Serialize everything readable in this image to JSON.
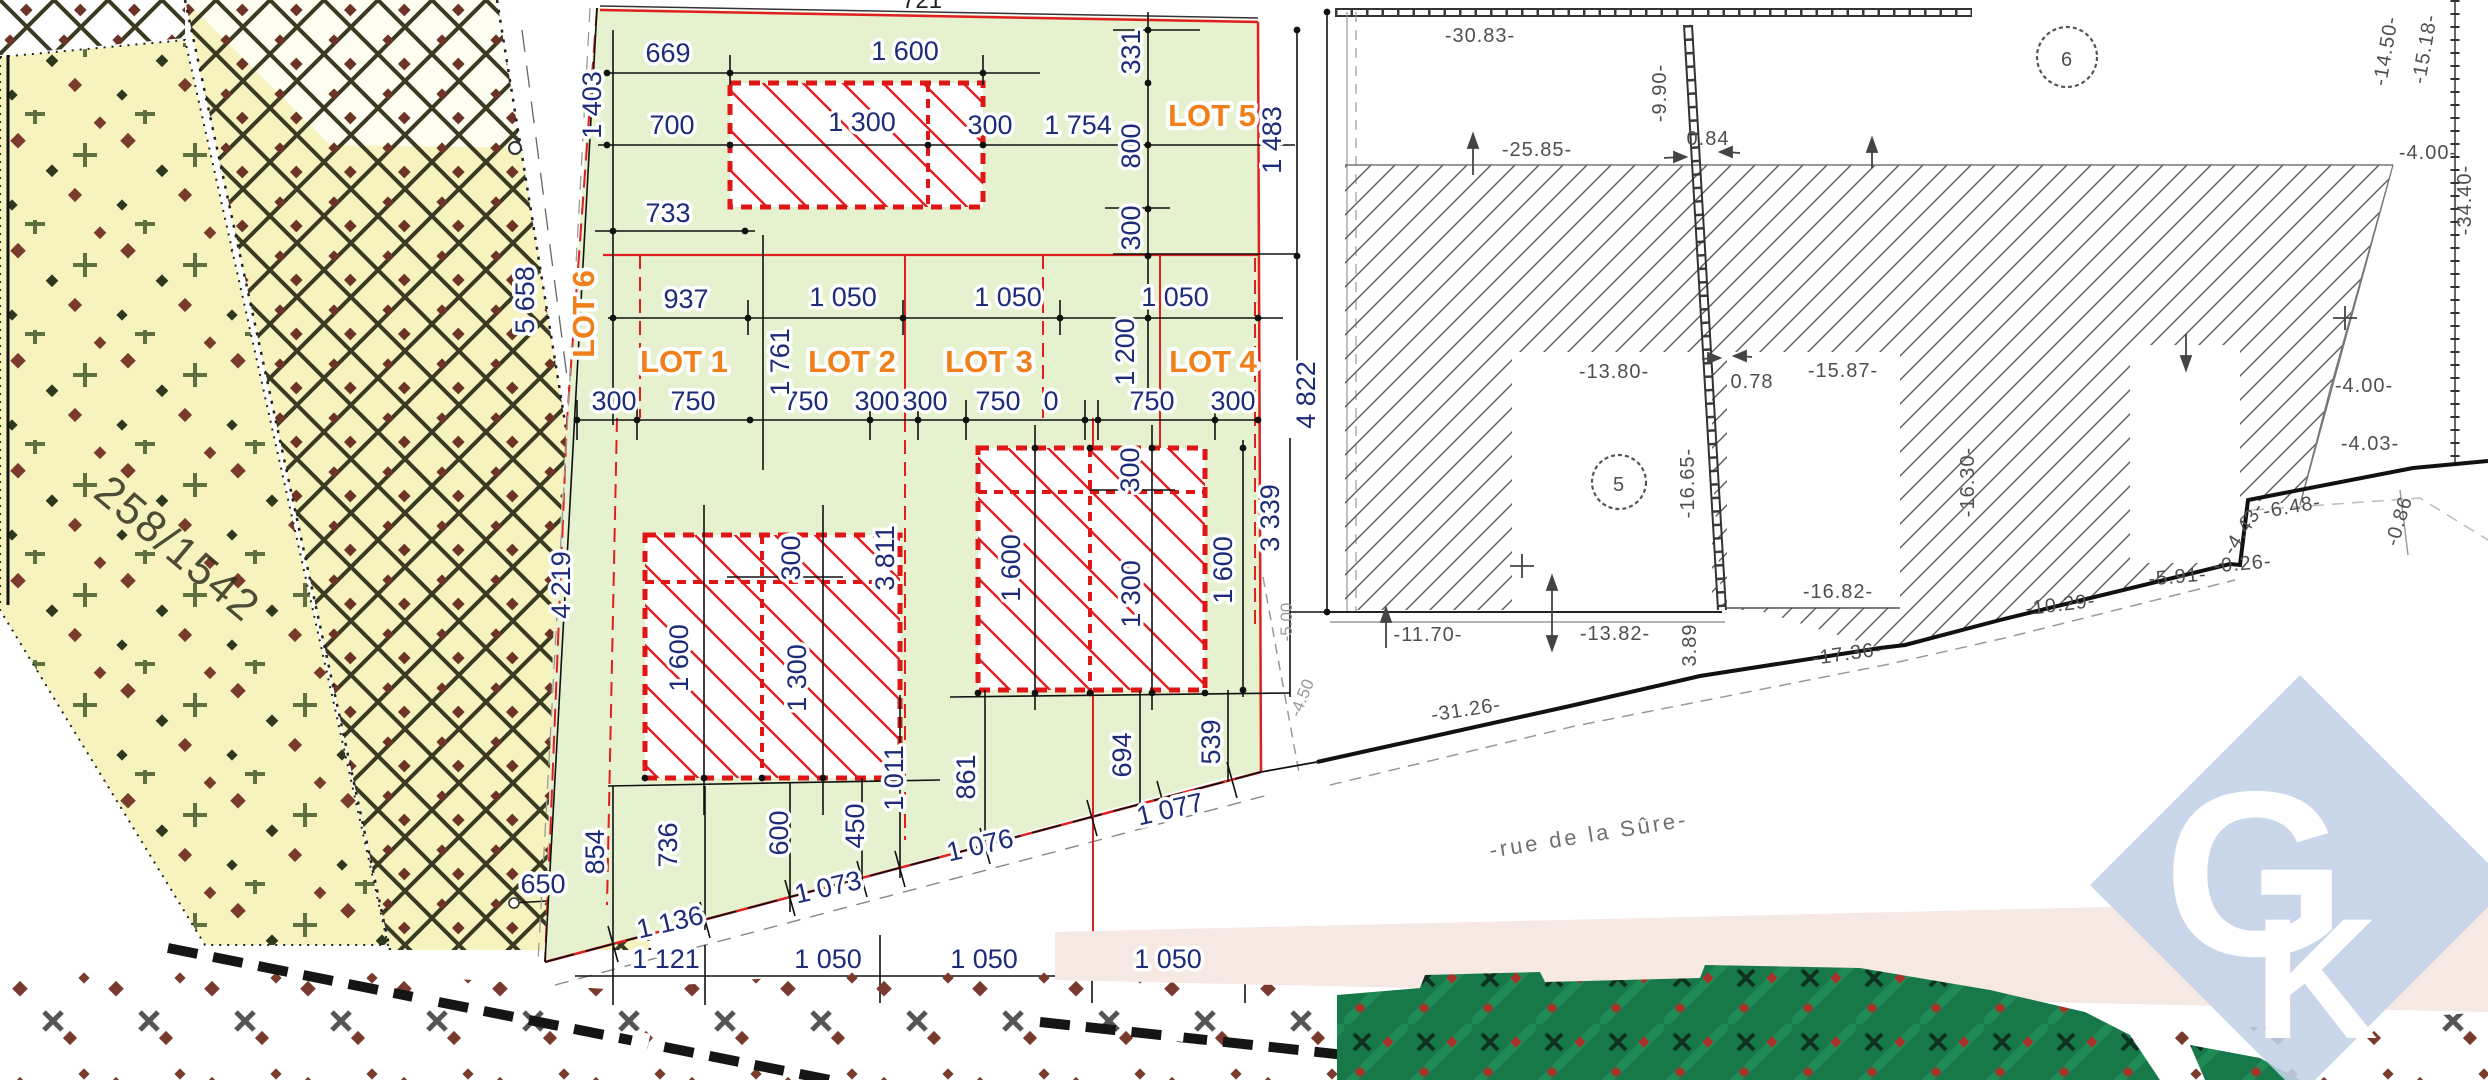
{
  "plan": {
    "street_name": "-rue de la Sûre-",
    "parcel_number": "258/1542",
    "lot_names": [
      "LOT 1",
      "LOT 2",
      "LOT 3",
      "LOT 4",
      "LOT 5",
      "LOT 6"
    ],
    "circled_parcels": [
      "5",
      "6"
    ]
  },
  "logo": {
    "g": "G",
    "k": "K"
  },
  "colors": {
    "green_area": "#e5f1cf",
    "lot_label_orange": "#f07f1a",
    "dimension_navy": "#1c2c78",
    "building_red": "#e01515",
    "parcel_yellow": "#f6f3bf",
    "pink_band": "#f6e8e3",
    "dark_green": "#17794a",
    "logo_blue": "#c3d2e8",
    "survey_grey": "#4f4f4f"
  },
  "labels": [
    {
      "t": "669",
      "x": 668,
      "y": 62,
      "r": 0,
      "c": "dim"
    },
    {
      "t": "1 600",
      "x": 905,
      "y": 60,
      "r": 0,
      "c": "dim"
    },
    {
      "t": "700",
      "x": 672,
      "y": 134,
      "r": 0,
      "c": "dim"
    },
    {
      "t": "1 300",
      "x": 862,
      "y": 131,
      "r": 0,
      "c": "dim"
    },
    {
      "t": "300",
      "x": 990,
      "y": 134,
      "r": 0,
      "c": "dim"
    },
    {
      "t": "733",
      "x": 668,
      "y": 222,
      "r": 0,
      "c": "dim"
    },
    {
      "t": "1 754",
      "x": 1078,
      "y": 134,
      "r": 0,
      "c": "dim"
    },
    {
      "t": "937",
      "x": 686,
      "y": 308,
      "r": 0,
      "c": "dim"
    },
    {
      "t": "1 050",
      "x": 843,
      "y": 306,
      "r": 0,
      "c": "dim"
    },
    {
      "t": "1 050",
      "x": 1008,
      "y": 306,
      "r": 0,
      "c": "dim"
    },
    {
      "t": "1 050",
      "x": 1175,
      "y": 306,
      "r": 0,
      "c": "dim"
    },
    {
      "t": "300",
      "x": 614,
      "y": 410,
      "r": 0,
      "c": "dim"
    },
    {
      "t": "750",
      "x": 693,
      "y": 410,
      "r": 0,
      "c": "dim"
    },
    {
      "t": "750",
      "x": 806,
      "y": 410,
      "r": 0,
      "c": "dim"
    },
    {
      "t": "300",
      "x": 877,
      "y": 410,
      "r": 0,
      "c": "dim"
    },
    {
      "t": "300",
      "x": 925,
      "y": 410,
      "r": 0,
      "c": "dim"
    },
    {
      "t": "750",
      "x": 998,
      "y": 410,
      "r": 0,
      "c": "dim"
    },
    {
      "t": "0",
      "x": 1051,
      "y": 410,
      "r": 0,
      "c": "dim"
    },
    {
      "t": "750",
      "x": 1152,
      "y": 410,
      "r": 0,
      "c": "dim"
    },
    {
      "t": "300",
      "x": 1233,
      "y": 410,
      "r": 0,
      "c": "dim"
    },
    {
      "t": "650",
      "x": 543,
      "y": 893,
      "r": 0,
      "c": "dim"
    },
    {
      "t": "1 121",
      "x": 666,
      "y": 968,
      "r": 0,
      "c": "dim"
    },
    {
      "t": "1 050",
      "x": 828,
      "y": 968,
      "r": 0,
      "c": "dim"
    },
    {
      "t": "1 050",
      "x": 984,
      "y": 968,
      "r": 0,
      "c": "dim"
    },
    {
      "t": "1 050",
      "x": 1168,
      "y": 968,
      "r": 0,
      "c": "dim"
    },
    {
      "t": "1 403",
      "x": 601,
      "y": 105,
      "r": -90,
      "c": "dim"
    },
    {
      "t": "331",
      "x": 1140,
      "y": 52,
      "r": -90,
      "c": "dim"
    },
    {
      "t": "800",
      "x": 1140,
      "y": 146,
      "r": -90,
      "c": "dim"
    },
    {
      "t": "300",
      "x": 1140,
      "y": 228,
      "r": -90,
      "c": "dim"
    },
    {
      "t": "1 483",
      "x": 1281,
      "y": 140,
      "r": -90,
      "c": "dim"
    },
    {
      "t": "4 822",
      "x": 1315,
      "y": 395,
      "r": -90,
      "c": "dim"
    },
    {
      "t": "1 761",
      "x": 789,
      "y": 362,
      "r": -90,
      "c": "dim"
    },
    {
      "t": "1 200",
      "x": 1134,
      "y": 352,
      "r": -90,
      "c": "dim"
    },
    {
      "t": "5 658",
      "x": 534,
      "y": 300,
      "r": -90,
      "c": "dim"
    },
    {
      "t": "4 219",
      "x": 570,
      "y": 585,
      "r": -90,
      "c": "dim"
    },
    {
      "t": "300",
      "x": 800,
      "y": 558,
      "r": -90,
      "c": "dim"
    },
    {
      "t": "1 600",
      "x": 688,
      "y": 658,
      "r": -90,
      "c": "dim"
    },
    {
      "t": "1 300",
      "x": 806,
      "y": 678,
      "r": -90,
      "c": "dim"
    },
    {
      "t": "3 811",
      "x": 894,
      "y": 558,
      "r": -90,
      "c": "dim"
    },
    {
      "t": "450",
      "x": 864,
      "y": 826,
      "r": -90,
      "c": "dim"
    },
    {
      "t": "1 011",
      "x": 903,
      "y": 778,
      "r": -90,
      "c": "dim"
    },
    {
      "t": "854",
      "x": 604,
      "y": 852,
      "r": -90,
      "c": "dim"
    },
    {
      "t": "736",
      "x": 677,
      "y": 845,
      "r": -90,
      "c": "dim"
    },
    {
      "t": "600",
      "x": 788,
      "y": 833,
      "r": -90,
      "c": "dim"
    },
    {
      "t": "861",
      "x": 975,
      "y": 777,
      "r": -90,
      "c": "dim"
    },
    {
      "t": "694",
      "x": 1131,
      "y": 755,
      "r": -90,
      "c": "dim"
    },
    {
      "t": "539",
      "x": 1220,
      "y": 742,
      "r": -90,
      "c": "dim"
    },
    {
      "t": "300",
      "x": 1139,
      "y": 470,
      "r": -90,
      "c": "dim"
    },
    {
      "t": "1 600",
      "x": 1020,
      "y": 568,
      "r": -90,
      "c": "dim"
    },
    {
      "t": "1 300",
      "x": 1140,
      "y": 594,
      "r": -90,
      "c": "dim"
    },
    {
      "t": "1 600",
      "x": 1232,
      "y": 570,
      "r": -90,
      "c": "dim"
    },
    {
      "t": "3 339",
      "x": 1279,
      "y": 518,
      "r": -90,
      "c": "dim"
    },
    {
      "t": "1 136",
      "x": 672,
      "y": 931,
      "r": -13,
      "c": "dim"
    },
    {
      "t": "1 073",
      "x": 830,
      "y": 896,
      "r": -13,
      "c": "dim"
    },
    {
      "t": "1 076",
      "x": 982,
      "y": 854,
      "r": -13,
      "c": "dim"
    },
    {
      "t": "1 077",
      "x": 1172,
      "y": 818,
      "r": -13,
      "c": "dim"
    },
    {
      "t": "LOT 1",
      "x": 684,
      "y": 372,
      "r": 0,
      "c": "lot"
    },
    {
      "t": "LOT 2",
      "x": 852,
      "y": 372,
      "r": 0,
      "c": "lot"
    },
    {
      "t": "LOT 3",
      "x": 989,
      "y": 372,
      "r": 0,
      "c": "lot"
    },
    {
      "t": "LOT 4",
      "x": 1213,
      "y": 372,
      "r": 0,
      "c": "lot"
    },
    {
      "t": "LOT 5",
      "x": 1212,
      "y": 126,
      "r": 0,
      "c": "lot"
    },
    {
      "t": "LOT 6",
      "x": 594,
      "y": 314,
      "r": -90,
      "c": "lot"
    },
    {
      "t": "-5.00",
      "x": 1292,
      "y": 622,
      "r": -90,
      "c": "grey"
    },
    {
      "t": "-4.50",
      "x": 1307,
      "y": 700,
      "r": -68,
      "c": "grey"
    },
    {
      "t": "-30.83-",
      "x": 1480,
      "y": 42,
      "r": 0,
      "c": "surv"
    },
    {
      "t": "-25.85-",
      "x": 1537,
      "y": 156,
      "r": 0,
      "c": "surv"
    },
    {
      "t": "0.84",
      "x": 1708,
      "y": 145,
      "r": 0,
      "c": "surv"
    },
    {
      "t": "-9.90-",
      "x": 1666,
      "y": 93,
      "r": -90,
      "c": "surv"
    },
    {
      "t": "-13.80-",
      "x": 1614,
      "y": 378,
      "r": 0,
      "c": "surv"
    },
    {
      "t": "0.78",
      "x": 1752,
      "y": 388,
      "r": 0,
      "c": "surv"
    },
    {
      "t": "-15.87-",
      "x": 1843,
      "y": 377,
      "r": 0,
      "c": "surv"
    },
    {
      "t": "-16.65-",
      "x": 1694,
      "y": 483,
      "r": -90,
      "c": "surv"
    },
    {
      "t": "-16.30-",
      "x": 1974,
      "y": 482,
      "r": -90,
      "c": "surv"
    },
    {
      "t": "-16.82-",
      "x": 1838,
      "y": 598,
      "r": 0,
      "c": "surv"
    },
    {
      "t": "-11.70-",
      "x": 1428,
      "y": 641,
      "r": 0,
      "c": "surv"
    },
    {
      "t": "-13.82-",
      "x": 1615,
      "y": 640,
      "r": 0,
      "c": "surv"
    },
    {
      "t": "3.89",
      "x": 1696,
      "y": 645,
      "r": -90,
      "c": "surv"
    },
    {
      "t": "-17.36-",
      "x": 1848,
      "y": 660,
      "r": -8,
      "c": "surv"
    },
    {
      "t": "-10.29-",
      "x": 2061,
      "y": 611,
      "r": -7,
      "c": "surv"
    },
    {
      "t": "-5.91-",
      "x": 2178,
      "y": 583,
      "r": -5,
      "c": "surv"
    },
    {
      "t": "-0.26-",
      "x": 2243,
      "y": 570,
      "r": -5,
      "c": "surv"
    },
    {
      "t": "-4.43-",
      "x": 2249,
      "y": 532,
      "r": -57,
      "c": "surv"
    },
    {
      "t": "-6.48-",
      "x": 2293,
      "y": 513,
      "r": -10,
      "c": "surv"
    },
    {
      "t": "-0.86",
      "x": 2405,
      "y": 523,
      "r": -73,
      "c": "surv"
    },
    {
      "t": "-31.26-",
      "x": 1467,
      "y": 716,
      "r": -9,
      "c": "surv"
    },
    {
      "t": "-4.00-",
      "x": 2364,
      "y": 392,
      "r": 0,
      "c": "surv"
    },
    {
      "t": "-4.03-",
      "x": 2370,
      "y": 450,
      "r": 0,
      "c": "surv"
    },
    {
      "t": "-4.00-",
      "x": 2428,
      "y": 159,
      "r": 0,
      "c": "surv"
    },
    {
      "t": "-34.40-",
      "x": 2471,
      "y": 200,
      "r": -90,
      "c": "surv"
    },
    {
      "t": "-15.18-",
      "x": 2431,
      "y": 50,
      "r": -80,
      "c": "surv"
    },
    {
      "t": "-14.50-",
      "x": 2392,
      "y": 52,
      "r": -80,
      "c": "surv"
    },
    {
      "t": "6",
      "x": 2067,
      "y": 66,
      "r": 0,
      "c": "surv"
    },
    {
      "t": "5",
      "x": 1619,
      "y": 491,
      "r": 0,
      "c": "surv"
    },
    {
      "t": "-rue de la Sûre-",
      "x": 1590,
      "y": 842,
      "r": -9,
      "c": "street"
    },
    {
      "t": "258/1542",
      "x": 168,
      "y": 560,
      "r": 40,
      "c": "parcel"
    },
    {
      "t": "721",
      "x": 922,
      "y": 8,
      "r": 0,
      "c": "frag"
    }
  ]
}
